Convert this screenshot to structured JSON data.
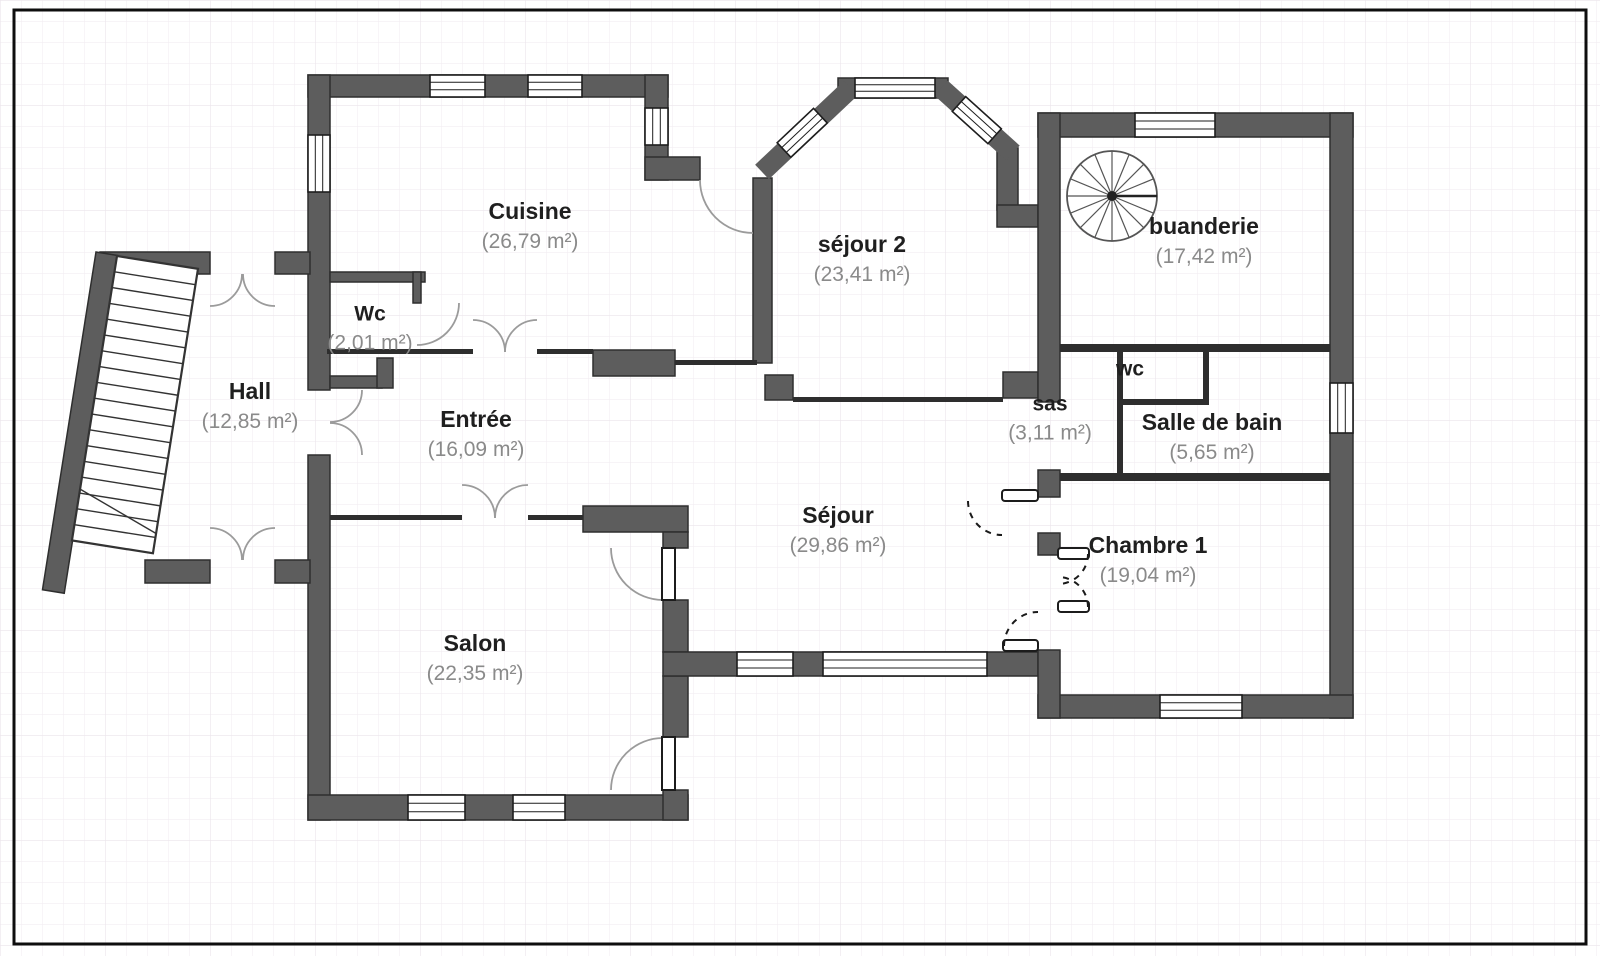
{
  "rooms": [
    {
      "id": "hall",
      "name": "Hall",
      "area": "(12,85 m²)"
    },
    {
      "id": "wc1",
      "name": "Wc",
      "area": "(2,01 m²)"
    },
    {
      "id": "cuisine",
      "name": "Cuisine",
      "area": "(26,79 m²)"
    },
    {
      "id": "entree",
      "name": "Entrée",
      "area": "(16,09 m²)"
    },
    {
      "id": "salon",
      "name": "Salon",
      "area": "(22,35 m²)"
    },
    {
      "id": "sejour",
      "name": "Séjour",
      "area": "(29,86 m²)"
    },
    {
      "id": "sejour2",
      "name": "séjour 2",
      "area": "(23,41 m²)"
    },
    {
      "id": "buanderie",
      "name": "buanderie",
      "area": "(17,42 m²)"
    },
    {
      "id": "wc2",
      "name": "wc",
      "area": ""
    },
    {
      "id": "sas",
      "name": "sas",
      "area": "(3,11 m²)"
    },
    {
      "id": "sdb",
      "name": "Salle de bain",
      "area": "(5,65 m²)"
    },
    {
      "id": "chambre1",
      "name": "Chambre 1",
      "area": "(19,04 m²)"
    }
  ],
  "icons": {
    "straight_stairs": "straight-staircase",
    "spiral_stairs": "spiral-staircase"
  },
  "colors": {
    "wall_fill": "#5d5d5d",
    "wall_outline": "#2e2e2e",
    "room_name_text": "#1f1f1f",
    "room_area_text": "#8a8a8a",
    "door_arc": "#9b9b9b",
    "grid_line": "#f2eef2"
  }
}
